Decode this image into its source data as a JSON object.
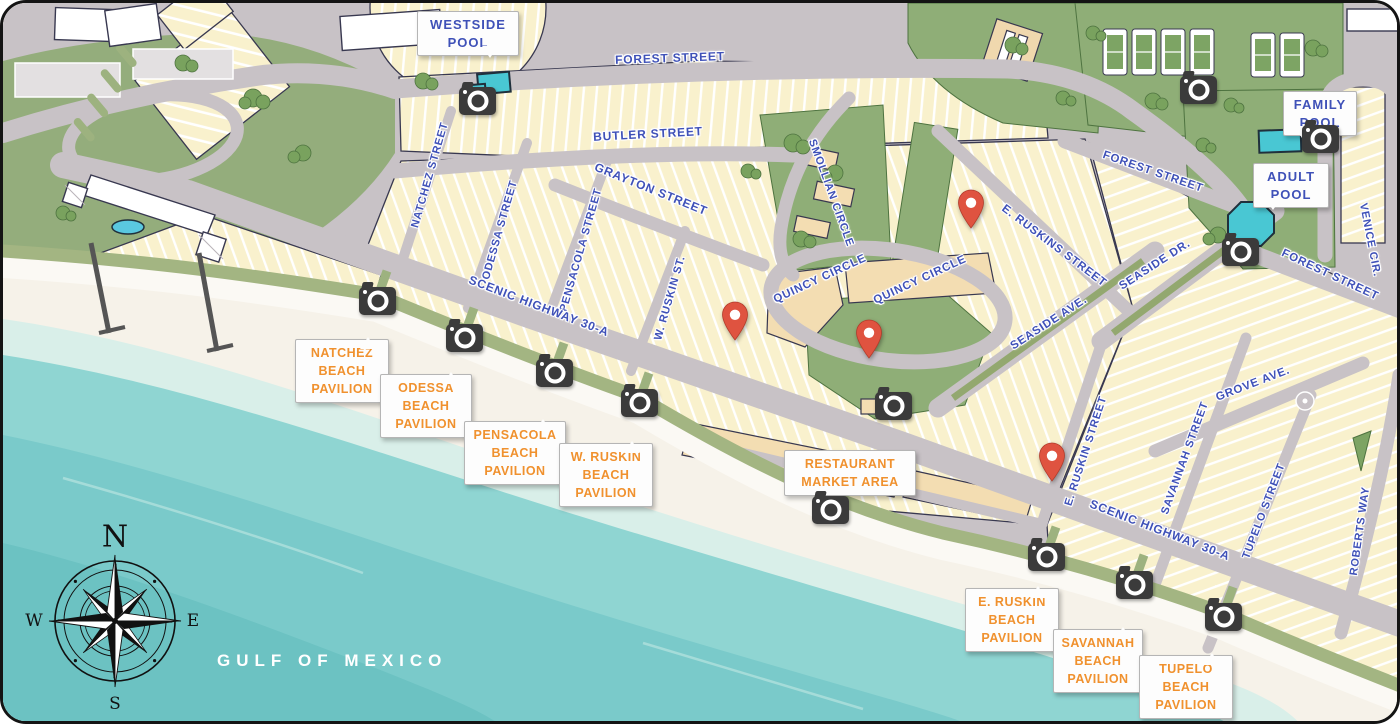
{
  "water": {
    "label": "GULF OF MEXICO"
  },
  "compass": {
    "north": "N",
    "east": "E",
    "south": "S",
    "west": "W"
  },
  "streets": [
    "FOREST STREET",
    "BUTLER STREET",
    "GRAYTON STREET",
    "NATCHEZ STREET",
    "ODESSA STREET",
    "PENSACOLA STREET",
    "W. RUSKIN ST.",
    "SMOLLIAN CIRCLE",
    "QUINCY CIRCLE",
    "QUINCY CIRCLE",
    "E. RUSKINS STREET",
    "SEASIDE DR.",
    "SEASIDE AVE.",
    "FOREST STREET",
    "FOREST STREET",
    "VENICE CIR.",
    "E. RUSKIN STREET",
    "SAVANNAH STREET",
    "TUPELO STREET",
    "GROVE AVE.",
    "ROBERTS WAY",
    "SCENIC HIGHWAY 30-A",
    "SCENIC HIGHWAY 30-A"
  ],
  "callouts": {
    "westside_pool": "WESTSIDE\nPOOL",
    "family_pool": "FAMILY\nPOOL",
    "adult_pool": "ADULT\nPOOL",
    "natchez_pavilion": "NATCHEZ\nBEACH\nPAVILION",
    "odessa_pavilion": "ODESSA\nBEACH\nPAVILION",
    "pensacola_pavilion": "PENSACOLA\nBEACH\nPAVILION",
    "w_ruskin_pavilion": "W. RUSKIN\nBEACH\nPAVILION",
    "restaurant_market": "RESTAURANT\nMARKET AREA",
    "e_ruskin_pavilion": "E. RUSKIN\nBEACH\nPAVILION",
    "savannah_pavilion": "SAVANNAH\nBEACH\nPAVILION",
    "tupelo_pavilion": "TUPELO\nBEACH\nPAVILION"
  },
  "icons": {
    "camera": "webcam-marker",
    "pin": "location-pin"
  },
  "palette": {
    "water": "#8fd5d2",
    "sand": "#f6f2e9",
    "road": "#c8c2c6",
    "lot": "#f9f1cd",
    "park": "#8fae77",
    "pool": "#49c7d3",
    "street_label": "#3f51b8",
    "pavilion_label": "#f0912e",
    "pin": "#df5340",
    "camera": "#3b3b3b"
  }
}
